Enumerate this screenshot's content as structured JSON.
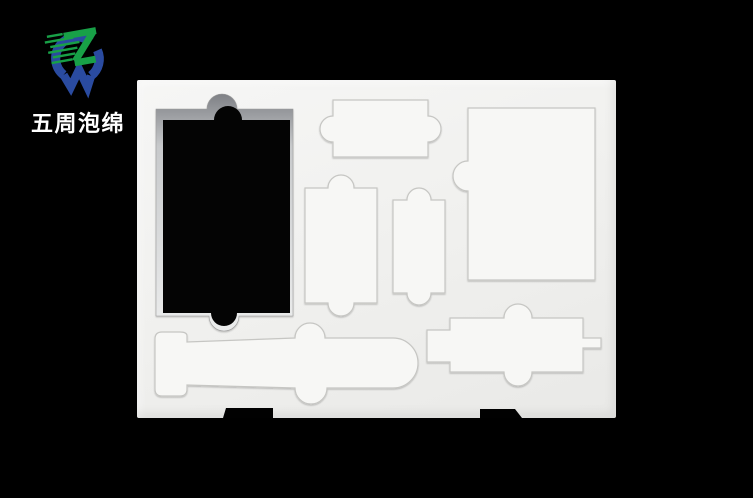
{
  "brand": {
    "name": "五周泡绵"
  },
  "colors": {
    "background": "#000000",
    "foam": "#f1f1ef",
    "foam_piece": "#f7f7f5",
    "cut_line": "#c6c6c3",
    "through_hole": "#040404",
    "logo_blue": "#2a4ba0",
    "logo_green": "#18a047",
    "logo_text": "#ffffff"
  },
  "icons": [
    {
      "name": "zw-logo-icon",
      "description": "blue W ring crossed by green Z with speed streaks"
    }
  ],
  "scene": {
    "type": "product-photo",
    "subject": "white die-cut foam packaging insert tray on black background",
    "cutouts": [
      {
        "id": "through-hole",
        "shape": "large rectangle with semicircular finger tabs top and bottom, cut fully through foam"
      },
      {
        "id": "slot-top-middle",
        "shape": "horizontal rectangle with semicircular tabs on left and right sides"
      },
      {
        "id": "slot-mid-left",
        "shape": "vertical rectangle with semicircular tabs top and bottom"
      },
      {
        "id": "slot-mid-right",
        "shape": "narrow vertical rectangle with semicircular tabs top and bottom"
      },
      {
        "id": "slot-top-right",
        "shape": "large rectangle with semicircular tab on left edge"
      },
      {
        "id": "slot-submarine",
        "shape": "torpedo outline with tail fin, top tower tab, bottom tab and rounded nose"
      },
      {
        "id": "slot-bottom-right",
        "shape": "horizontal rectangle with left tab, right stub and semicircular tabs top and bottom"
      },
      {
        "id": "edge-notch-left",
        "shape": "black notch cut in bottom edge of tray"
      },
      {
        "id": "edge-notch-right",
        "shape": "black notch cut in bottom edge of tray"
      }
    ]
  }
}
